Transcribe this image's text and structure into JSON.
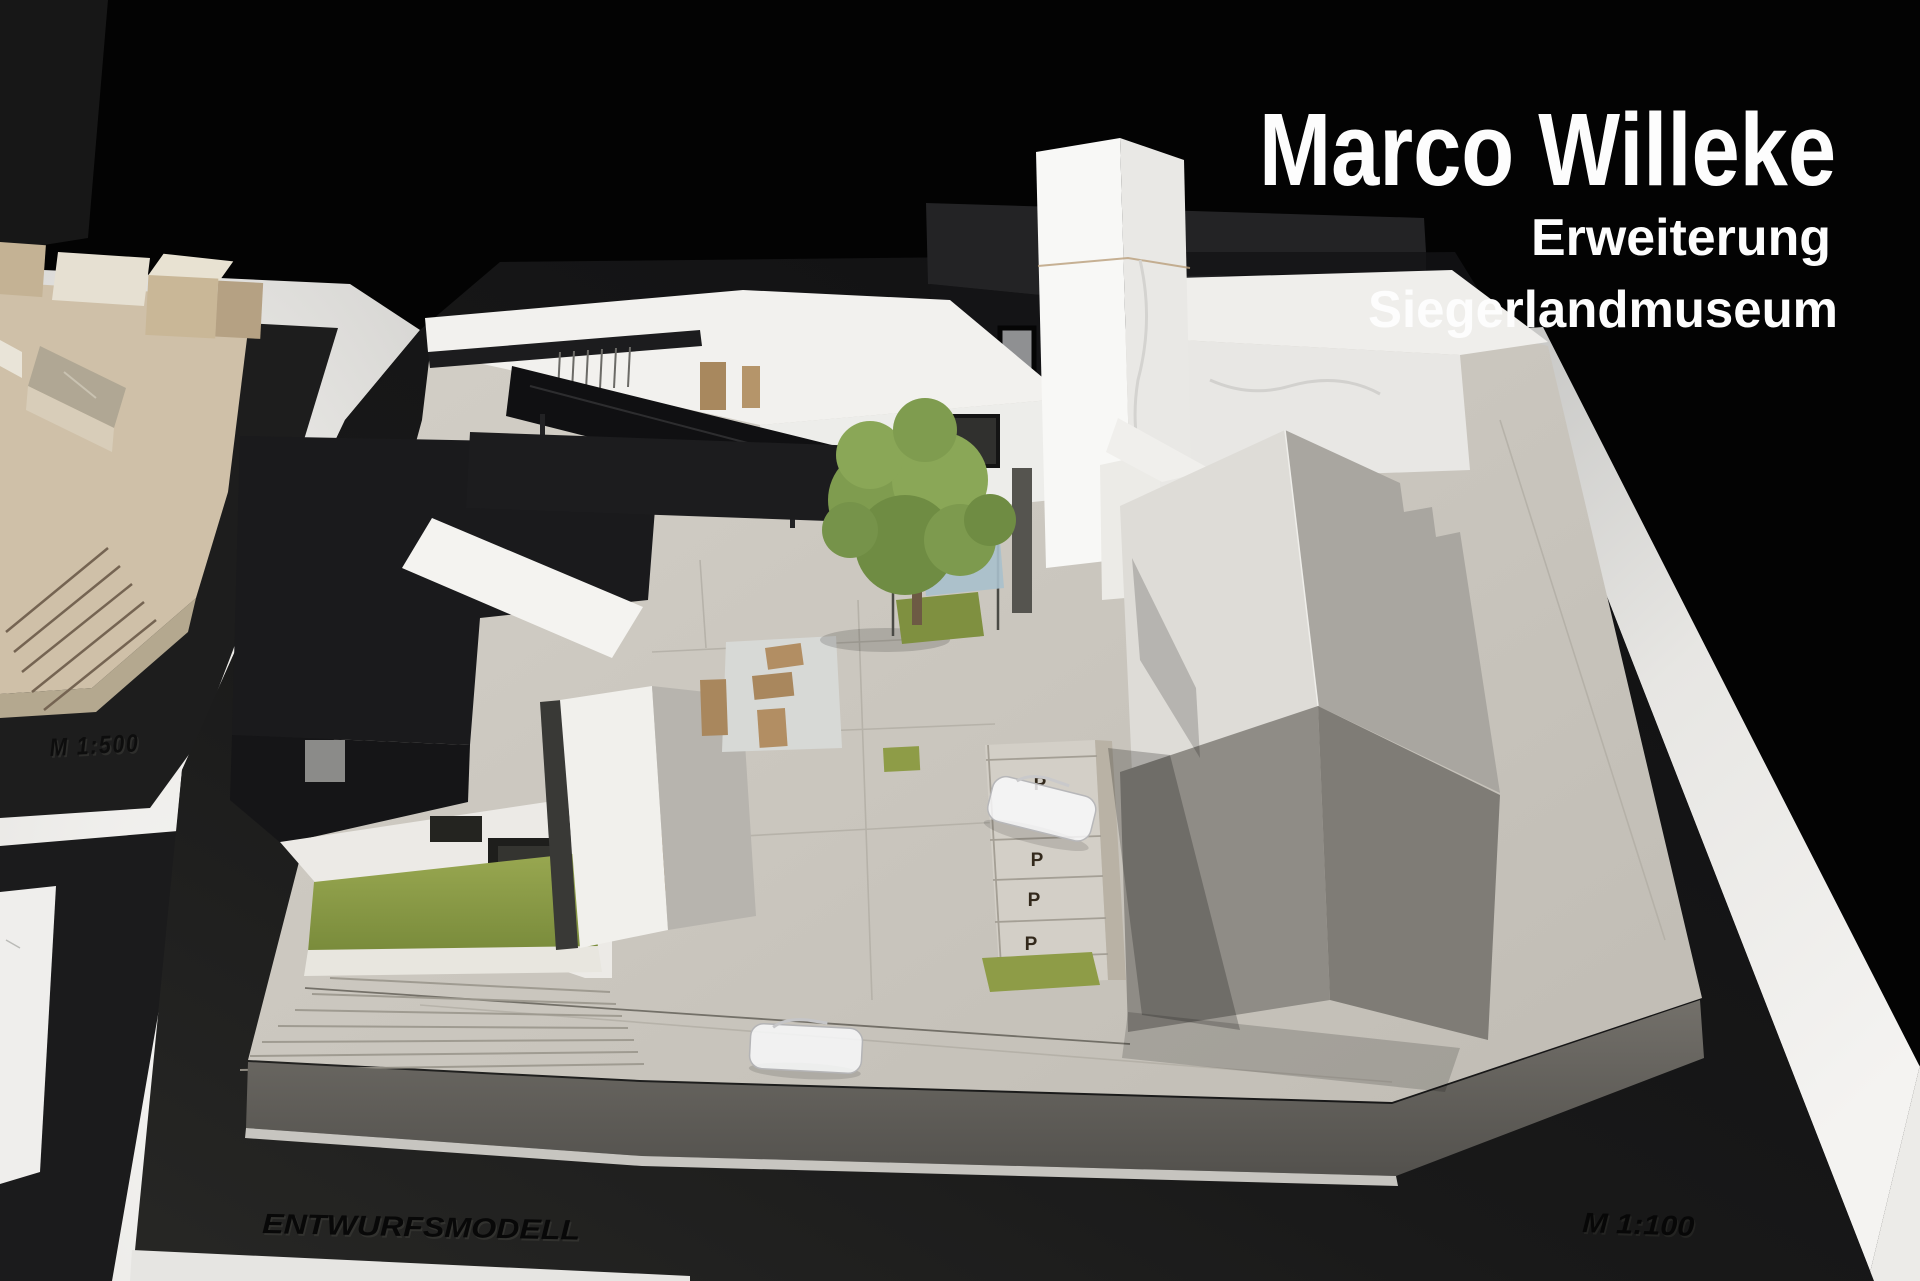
{
  "photo": {
    "subject": "Photograph of an architectural design model (Entwurfsmodell) on a white table against a black background",
    "width_px": 1920,
    "height_px": 1281
  },
  "overlay": {
    "author": "Marco Willeke",
    "project_line1": "Erweiterung",
    "project_line2": "Siegerlandmuseum",
    "text_color": "#fdfdfd"
  },
  "base_labels": {
    "context_scale": "M 1:500",
    "model_name": "ENTWURFSMODELL",
    "model_scale": "M 1:100"
  },
  "parking": {
    "marks": [
      "P",
      "P",
      "P",
      "P"
    ]
  },
  "palette": {
    "background": "#030303",
    "table_white": "#efeeec",
    "base_black": "#161616",
    "platform_gray": "#ccc8c0",
    "roof_black": "#1a1a1c",
    "building_white": "#f2f1ee",
    "gable_roof_lit": "#dedcd7",
    "gable_roof_shade": "#a9a6a0",
    "grass_green": "#8e9c47",
    "tree_green": "#7f9c4f",
    "wood_brown": "#b28e63",
    "water_blue": "#a9c0cc",
    "etched_text": "#080808",
    "parking_letter": "#33291c"
  }
}
